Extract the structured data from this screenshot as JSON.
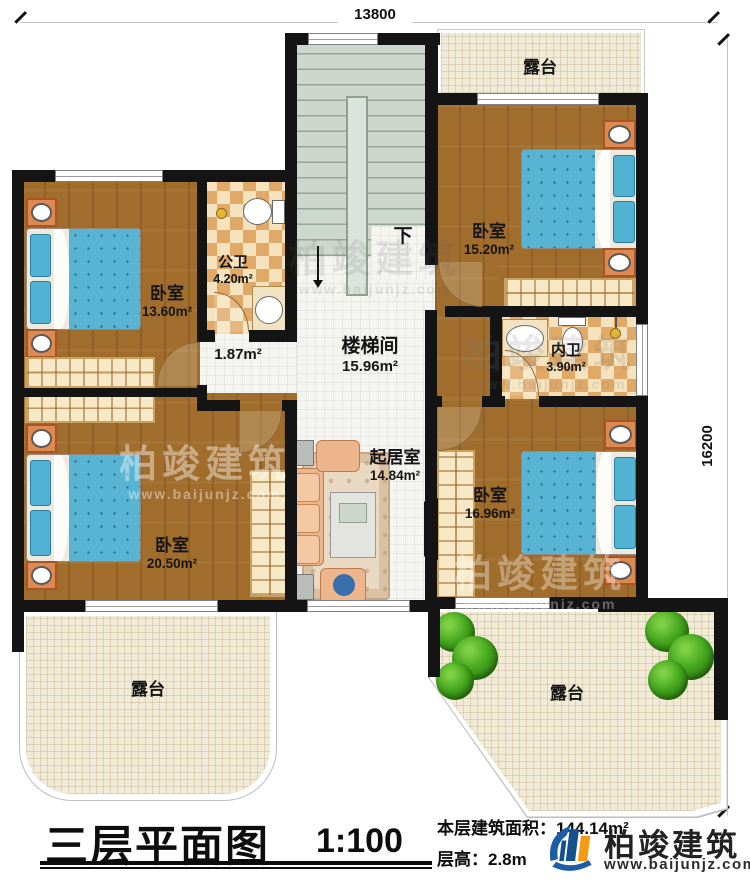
{
  "plan": {
    "dimension_top": "13800",
    "dimension_right": "16200",
    "stair_down": "下"
  },
  "rooms": {
    "terrace_top": {
      "name": "露台"
    },
    "bedroom_top_right": {
      "name": "卧室",
      "area": "15.20m²"
    },
    "bedroom_top_left": {
      "name": "卧室",
      "area": "13.60m²"
    },
    "public_bath": {
      "name": "公卫",
      "area": "4.20m²"
    },
    "hall": {
      "area": "1.87m²"
    },
    "stairwell": {
      "name": "楼梯间",
      "area": "15.96m²"
    },
    "inner_bath": {
      "name": "内卫",
      "area": "3.90m²"
    },
    "living_room": {
      "name": "起居室",
      "area": "14.84m²"
    },
    "bedroom_bottom_left": {
      "name": "卧室",
      "area": "20.50m²"
    },
    "bedroom_right": {
      "name": "卧室",
      "area": "16.96m²"
    },
    "terrace_bottom_left": {
      "name": "露台"
    },
    "terrace_bottom_right": {
      "name": "露台"
    }
  },
  "title_block": {
    "title": "三层平面图",
    "scale": "1:100",
    "floor_area_label": "本层建筑面积：",
    "floor_area_value": "144.14m²",
    "floor_height_label": "层高：",
    "floor_height_value": "2.8m"
  },
  "brand": {
    "name": "柏竣建筑",
    "website": "www.baijunjz.com"
  },
  "colors": {
    "wall": "#141414",
    "wood_floor": "#a06d2c",
    "tile_floor": "#f4f4f1",
    "stair_floor": "#ced7ce",
    "bath_checker": "#e0a967",
    "terrace_floor": "#f0ead7",
    "bed_blue": "#58b4d2",
    "brand_blue": "#1b5ea6",
    "brand_orange": "#f39a17"
  }
}
